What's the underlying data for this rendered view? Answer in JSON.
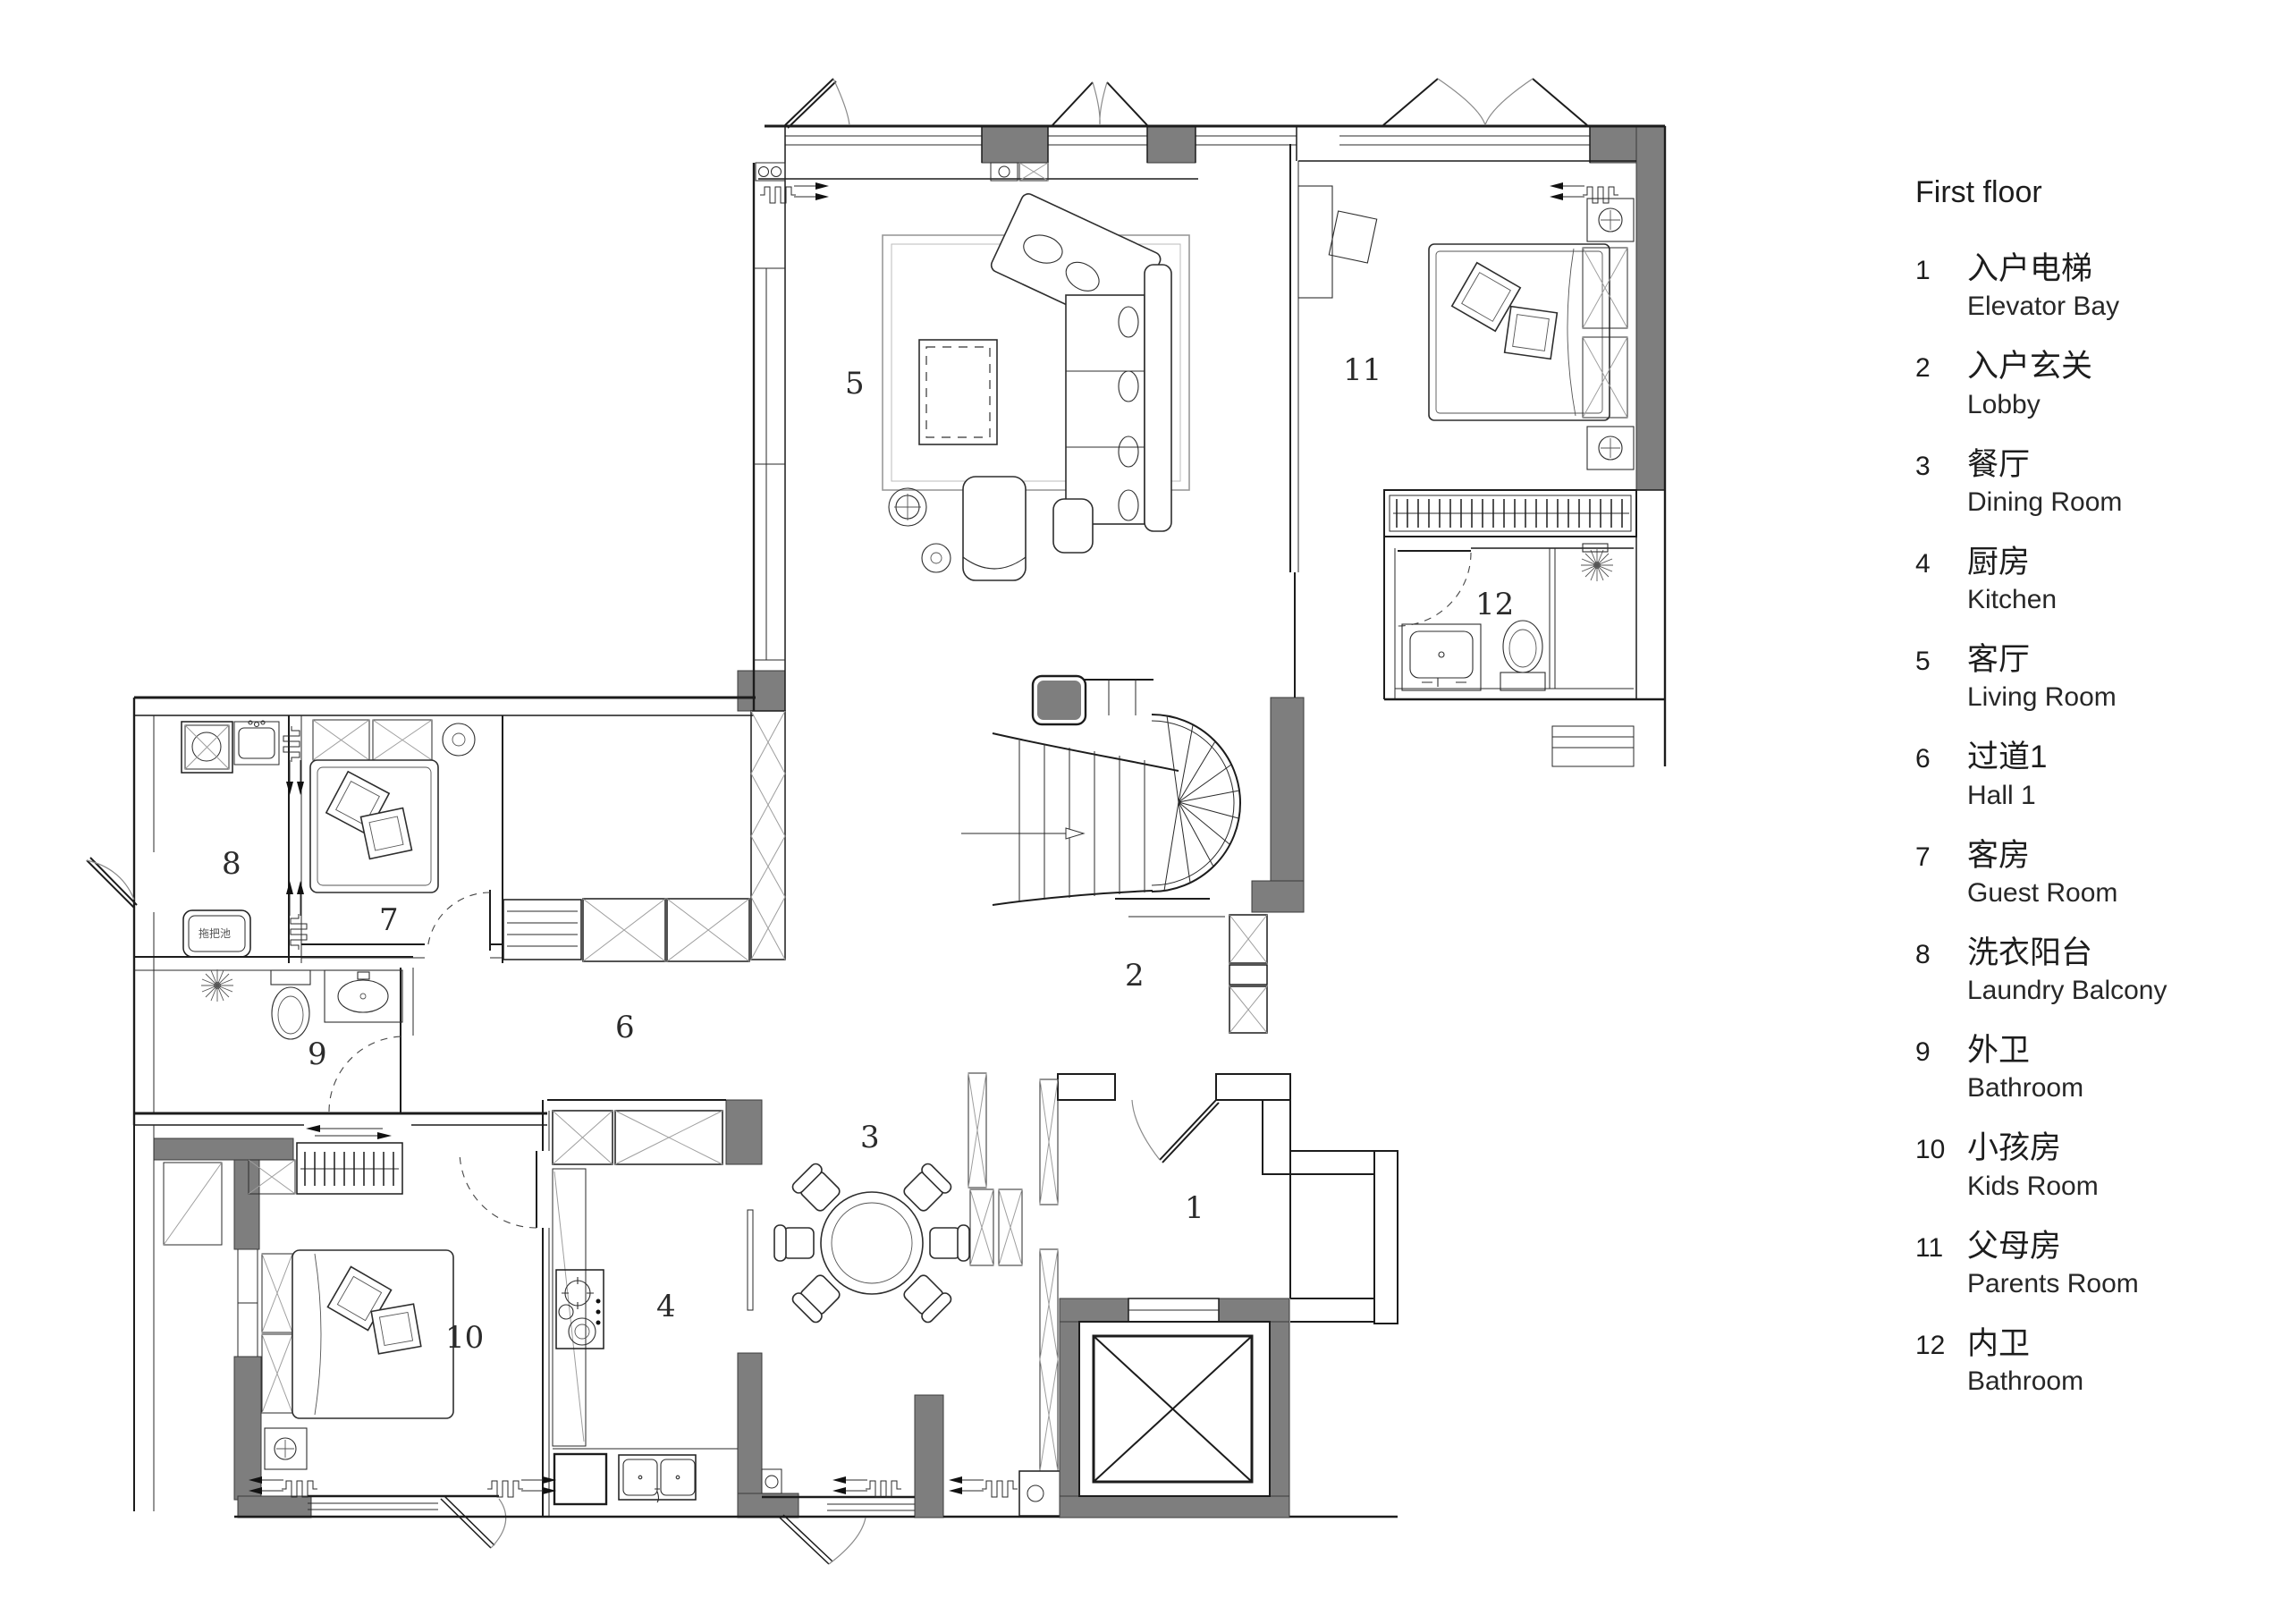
{
  "legend": {
    "title": "First floor",
    "items": [
      {
        "num": "1",
        "zh": "入户电梯",
        "en": "Elevator Bay"
      },
      {
        "num": "2",
        "zh": "入户玄关",
        "en": "Lobby"
      },
      {
        "num": "3",
        "zh": "餐厅",
        "en": "Dining Room"
      },
      {
        "num": "4",
        "zh": "厨房",
        "en": "Kitchen"
      },
      {
        "num": "5",
        "zh": "客厅",
        "en": "Living Room"
      },
      {
        "num": "6",
        "zh": "过道1",
        "en": "Hall 1"
      },
      {
        "num": "7",
        "zh": "客房",
        "en": "Guest Room"
      },
      {
        "num": "8",
        "zh": "洗衣阳台",
        "en": "Laundry Balcony"
      },
      {
        "num": "9",
        "zh": "外卫",
        "en": "Bathroom"
      },
      {
        "num": "10",
        "zh": "小孩房",
        "en": "Kids Room"
      },
      {
        "num": "11",
        "zh": "父母房",
        "en": "Parents Room"
      },
      {
        "num": "12",
        "zh": "内卫",
        "en": "Bathroom"
      }
    ]
  },
  "plan": {
    "room_labels": {
      "r1": "1",
      "r2": "2",
      "r3": "3",
      "r4": "4",
      "r5": "5",
      "r6": "6",
      "r7": "7",
      "r8": "8",
      "r9": "9",
      "r10": "10",
      "r11": "11",
      "r12": "12"
    },
    "fixture_labels": {
      "mop_sink": "拖把池"
    }
  },
  "colors": {
    "background": "#ffffff",
    "wall_poche": "#7e7e7e",
    "line": "#1c1c1c",
    "hatch": "#9e9e9e",
    "text": "#1d1d1d"
  }
}
